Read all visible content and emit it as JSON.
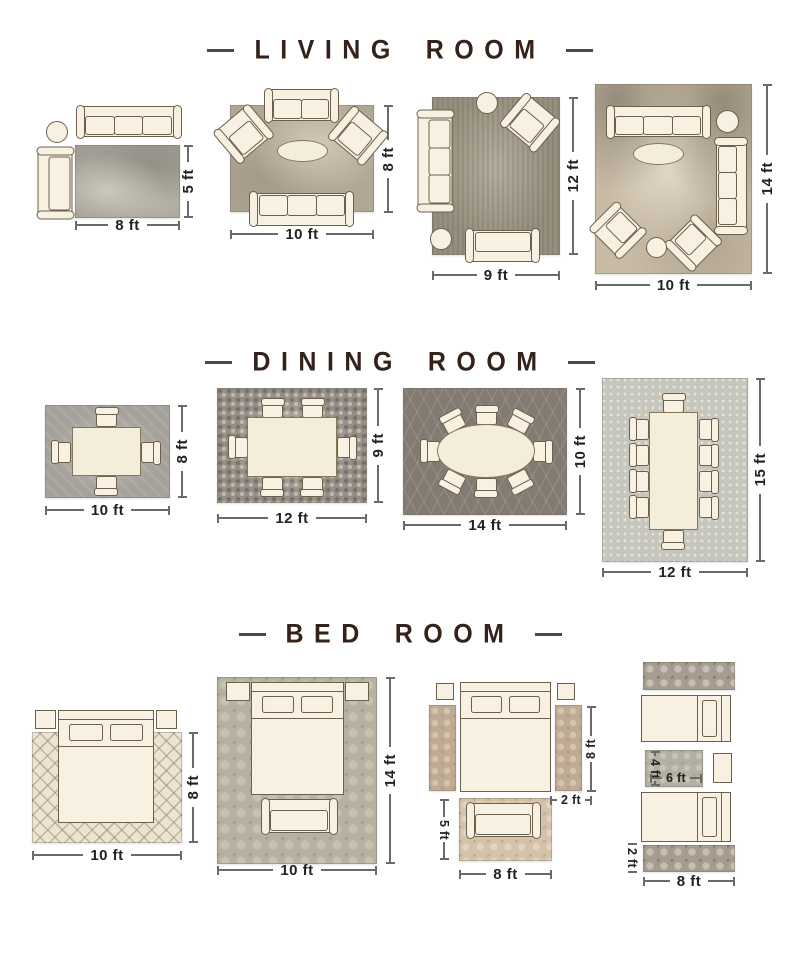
{
  "palette": {
    "background": "#ffffff",
    "title_text": "#33211a",
    "dimension_text": "#222222",
    "dimension_line": "#6a6a6a",
    "furniture_fill": "#f8f1e1",
    "furniture_outline": "#6b5f4d"
  },
  "sections": [
    {
      "title": "LIVING ROOM",
      "layouts": [
        {
          "name": "rug-8x5",
          "dims": {
            "width": "8 ft",
            "height": "5 ft"
          }
        },
        {
          "name": "rug-10x8",
          "dims": {
            "width": "10 ft",
            "height": "8 ft"
          }
        },
        {
          "name": "rug-9x12",
          "dims": {
            "width": "9 ft",
            "height": "12 ft"
          }
        },
        {
          "name": "rug-10x14",
          "dims": {
            "width": "10 ft",
            "height": "14 ft"
          }
        }
      ]
    },
    {
      "title": "DINING ROOM",
      "layouts": [
        {
          "name": "rug-10x8",
          "dims": {
            "width": "10 ft",
            "height": "8 ft"
          }
        },
        {
          "name": "rug-12x9",
          "dims": {
            "width": "12 ft",
            "height": "9 ft"
          }
        },
        {
          "name": "rug-14x10",
          "dims": {
            "width": "14 ft",
            "height": "10 ft"
          }
        },
        {
          "name": "rug-12x15",
          "dims": {
            "width": "12 ft",
            "height": "15 ft"
          }
        }
      ]
    },
    {
      "title": "BED ROOM",
      "layouts": [
        {
          "name": "rug-10x8",
          "dims": {
            "width": "10 ft",
            "height": "8 ft"
          }
        },
        {
          "name": "rug-10x14",
          "dims": {
            "width": "10 ft",
            "height": "14 ft"
          }
        },
        {
          "name": "bed-with-runners",
          "dims": {
            "runner_length": "8 ft",
            "runner_width": "2 ft",
            "foot_rug_height": "5 ft",
            "foot_rug_width": "8 ft"
          }
        },
        {
          "name": "twin-beds-runners",
          "dims": {
            "middle_rug_height": "4 ft",
            "middle_rug_width": "6 ft",
            "runner_width": "2 ft",
            "runner_length": "8 ft"
          }
        }
      ]
    }
  ]
}
